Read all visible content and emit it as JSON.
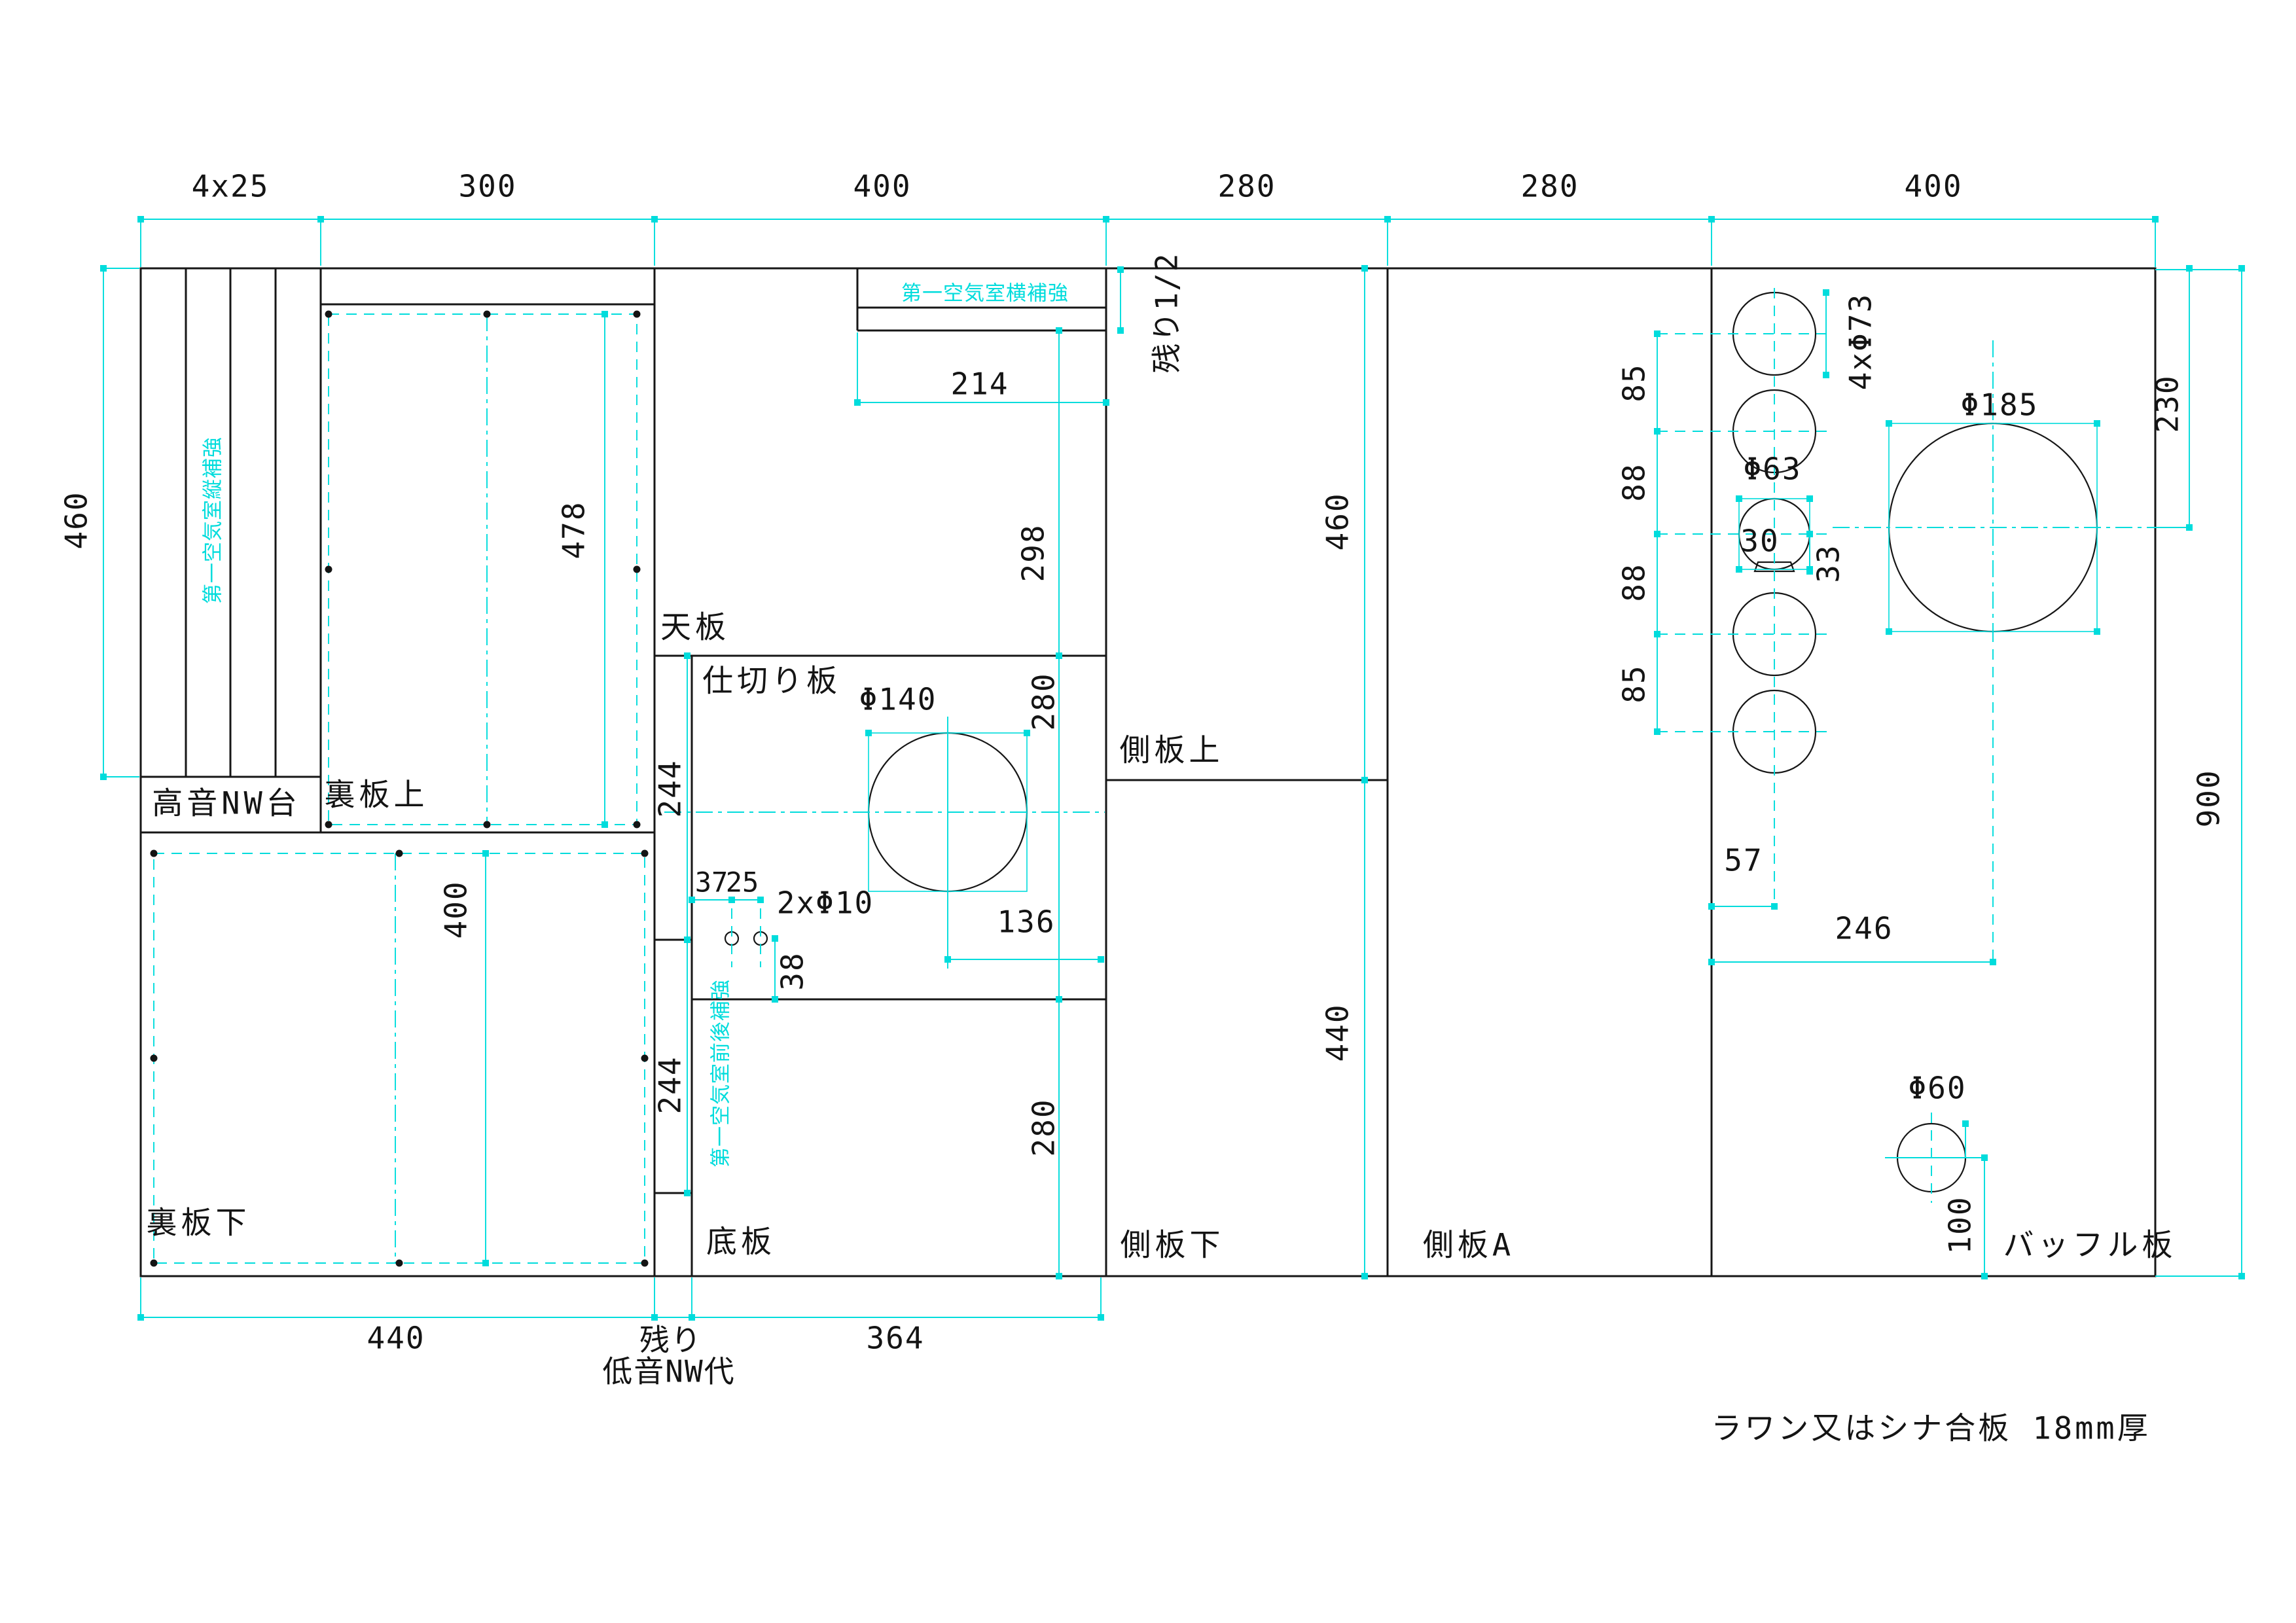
{
  "sheet_note": "ラワン又はシナ合板 18mm厚",
  "top_dims": {
    "strips": "4x25",
    "col2": "300",
    "col3": "400",
    "col4": "280",
    "col5": "280",
    "col6": "400"
  },
  "panels": {
    "tweeter_nw": "高音NW台",
    "back_upper": "裏板上",
    "back_lower": "裏板下",
    "top_plate": "天板",
    "divider_plate": "仕切り板",
    "bottom_plate": "底板",
    "side_upper": "側板上",
    "side_lower": "側板下",
    "side_a": "側板A",
    "baffle": "バッフル板"
  },
  "reinforcements": {
    "vertical": "第一空気室縦補強",
    "horizontal": "第一空気室横補強",
    "front_back": "第一空気室前後補強"
  },
  "leftover": {
    "half": "残り1/2",
    "line1": "残り",
    "line2": "低音NW代"
  },
  "dims": {
    "left_460": "460",
    "back_upper_478": "478",
    "back_lower_400": "400",
    "back_lower_440": "440",
    "top_plate_214": "214",
    "top_plate_298": "298",
    "divider_280": "280",
    "strip_244_upper": "244",
    "strip_244_lower": "244",
    "hole_37": "37",
    "hole_25": "25",
    "holes_2x10": "2xΦ10",
    "hole_38": "38",
    "center_136": "136",
    "bottom_280": "280",
    "bottom_364": "364",
    "side_460": "460",
    "side_440": "440",
    "gap_85a": "85",
    "gap_88a": "88",
    "gap_88b": "88",
    "gap_85b": "85",
    "drivers_4x73": "4xΦ73",
    "tweeter_63": "Φ63",
    "tweeter_30": "30",
    "tweeter_33": "33",
    "woofer_185": "Φ185",
    "right_230": "230",
    "center_246": "246",
    "edge_57": "57",
    "port_60": "Φ60",
    "port_100": "100",
    "height_900": "900",
    "port_140": "Φ140"
  },
  "colors": {
    "line": "#161616",
    "accent": "#00dcdc"
  }
}
